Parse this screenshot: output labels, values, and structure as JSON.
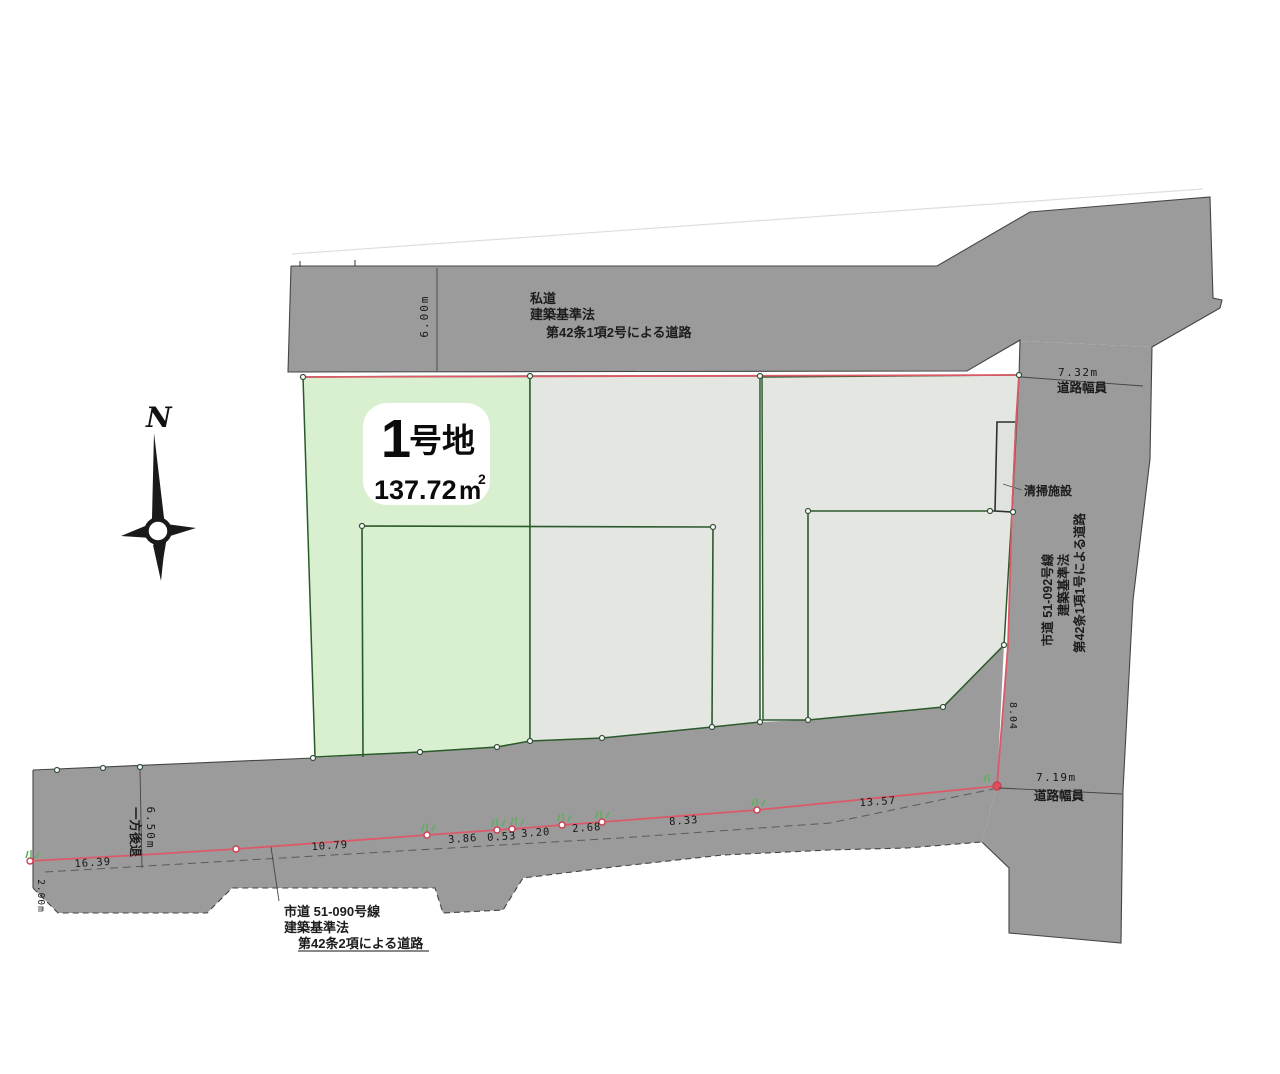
{
  "colors": {
    "road": "#9b9b9b",
    "plot_fill": "#e4e6e2",
    "lot_green": "#d8f0cf",
    "boundary_red": "#dc5a68",
    "parcel_green": "#2a5a2a",
    "line_dark": "#454545"
  },
  "compass": {
    "north_label": "N"
  },
  "lot1": {
    "number": "1",
    "name_suffix": "号地",
    "area_value": "137.72",
    "area_unit": "m",
    "area_unit_sup": "2"
  },
  "top_road": {
    "name": "私道",
    "law": "建築基準法",
    "clause": "第42条1項2号による道路",
    "width_dim": "6.00m"
  },
  "right_road": {
    "name": "市道 51-092号線",
    "law": "建築基準法",
    "clause": "第42条1項1号による道路",
    "width_top_value": "7.32m",
    "width_top_label": "道路幅員",
    "width_bottom_value": "7.19m",
    "width_bottom_label": "道路幅員",
    "edge_dim": "8.04"
  },
  "bottom_road": {
    "name": "市道 51-090号線",
    "law": "建築基準法",
    "clause": "第42条2項による道路",
    "setback_value": "6.50m",
    "setback_label": "一方後退",
    "left_dim": "2.00m",
    "segment_dims": [
      "16.39",
      "10.79",
      "3.86",
      "0.53",
      "3.20",
      "2.68",
      "8.33",
      "13.57"
    ]
  },
  "facility": {
    "label": "清掃施設"
  }
}
